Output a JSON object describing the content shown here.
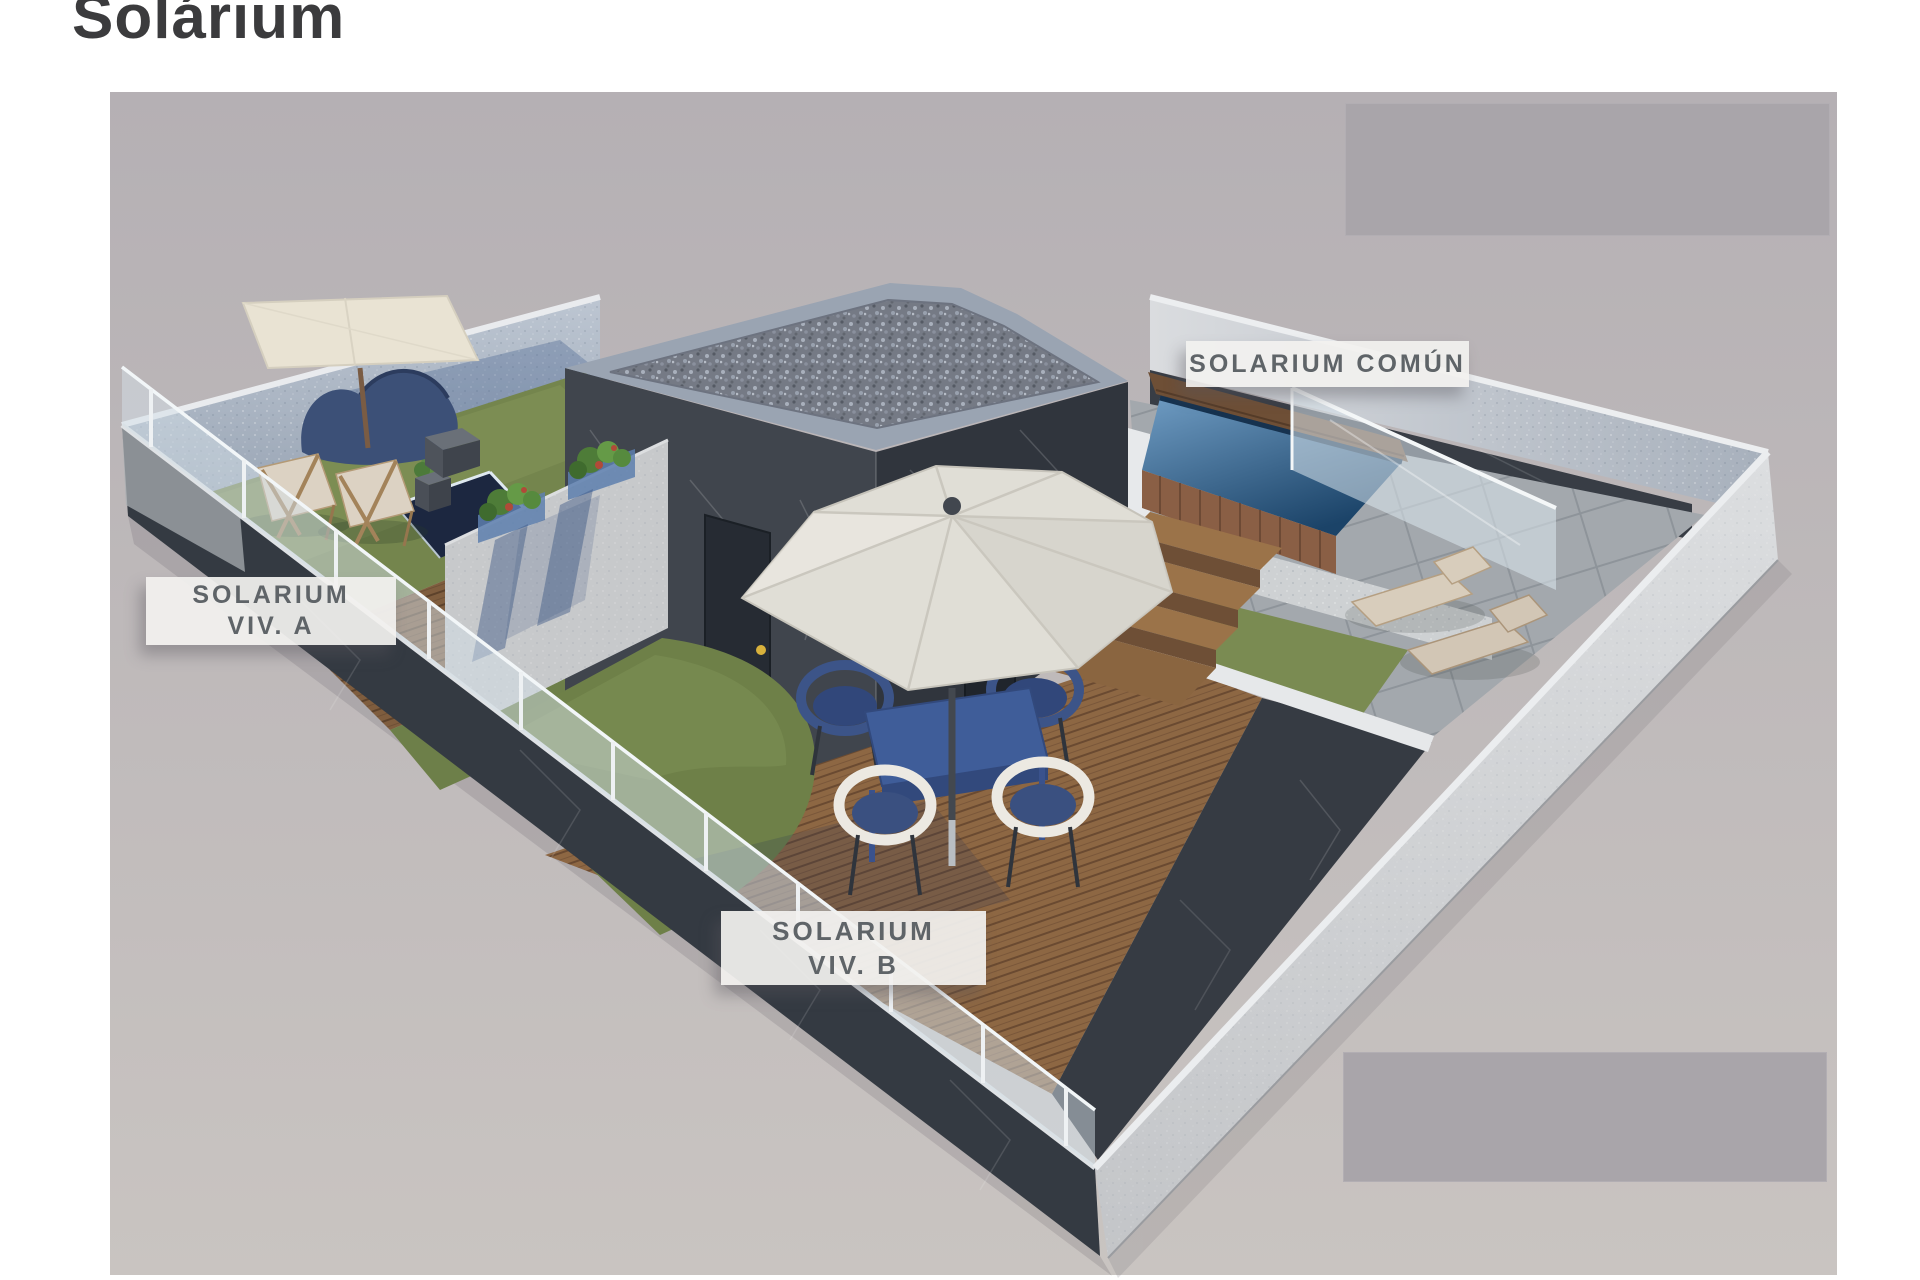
{
  "title": {
    "text": "Solárium"
  },
  "labels": {
    "viv_a": {
      "line1": "SOLARIUM",
      "line2": "VIV. A"
    },
    "viv_b": {
      "line1": "SOLARIUM",
      "line2": "VIV. B"
    },
    "comun": {
      "text": "SOLARIUM COMÚN"
    }
  },
  "scene": {
    "type": "3d-architectural-render",
    "subject": "rooftop solarium with three labelled terraces",
    "areas": [
      "Solarium Viv. A",
      "Solarium Viv. B",
      "Solarium Común"
    ],
    "colors": {
      "render_background": "#b7b2b5",
      "placeholder_gray": "#a9a5aa",
      "building_wall_dark": "#3c414a",
      "perimeter_wall_light": "#d2d4d6",
      "interior_wall_blue_gray": "#a5afbd",
      "grass_green": "#74854d",
      "deck_wood_brown": "#8d6743",
      "stone_tile_gray": "#a2a7ac",
      "pool_water_blue": "#2e5a85",
      "umbrella_cream": "#dfddd5",
      "furniture_blue": "#3c5488",
      "label_text": "#5f6468",
      "label_background": "#f1f0ee",
      "title_color": "#3b3b3d"
    }
  }
}
